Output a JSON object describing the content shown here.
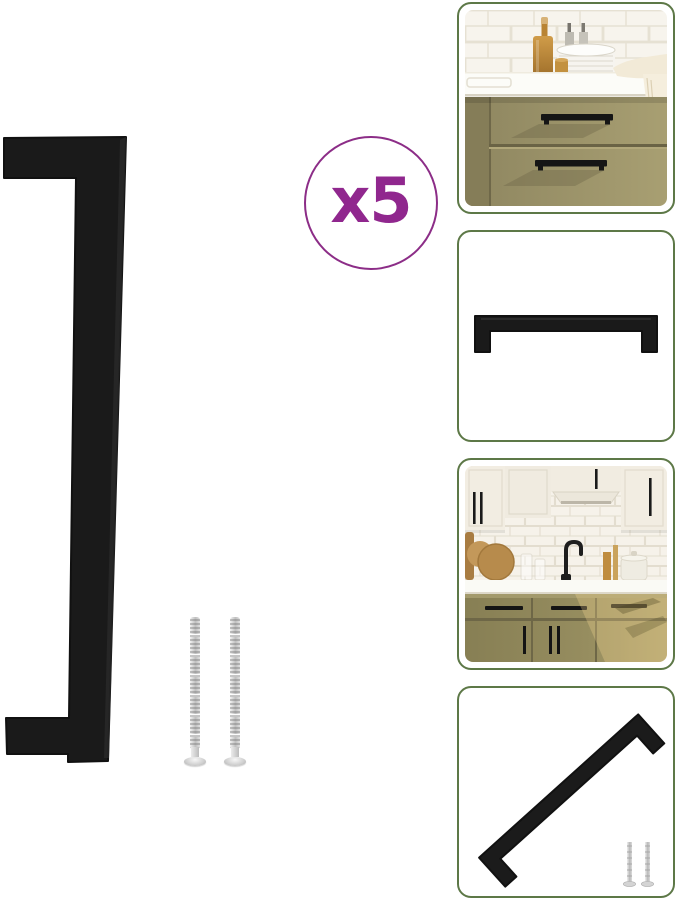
{
  "viewer": {
    "background": "#ffffff"
  },
  "main_image": {
    "badge_label": "x5",
    "subject": "black-square-cabinet-handle-with-mounting-screws",
    "accent_purple": "#90278e",
    "handle_black": "#1a1a1a",
    "screw_silver": "#c8c8c8",
    "screw_count": 2
  },
  "gallery": {
    "border_green": "#5d7847",
    "thumbnails": [
      {
        "subject": "kitchen-drawers-with-black-handles-closeup"
      },
      {
        "subject": "black-handle-horizontal-front-view"
      },
      {
        "subject": "kitchen-overview-with-handles-installed"
      },
      {
        "subject": "black-handle-diagonal-with-screws"
      }
    ]
  },
  "palette": {
    "cabinet_olive": "#9b9267",
    "tile_offwhite": "#f6f3ec",
    "counter_white": "#fbfbf7",
    "wall_cream": "#f1ece2"
  }
}
